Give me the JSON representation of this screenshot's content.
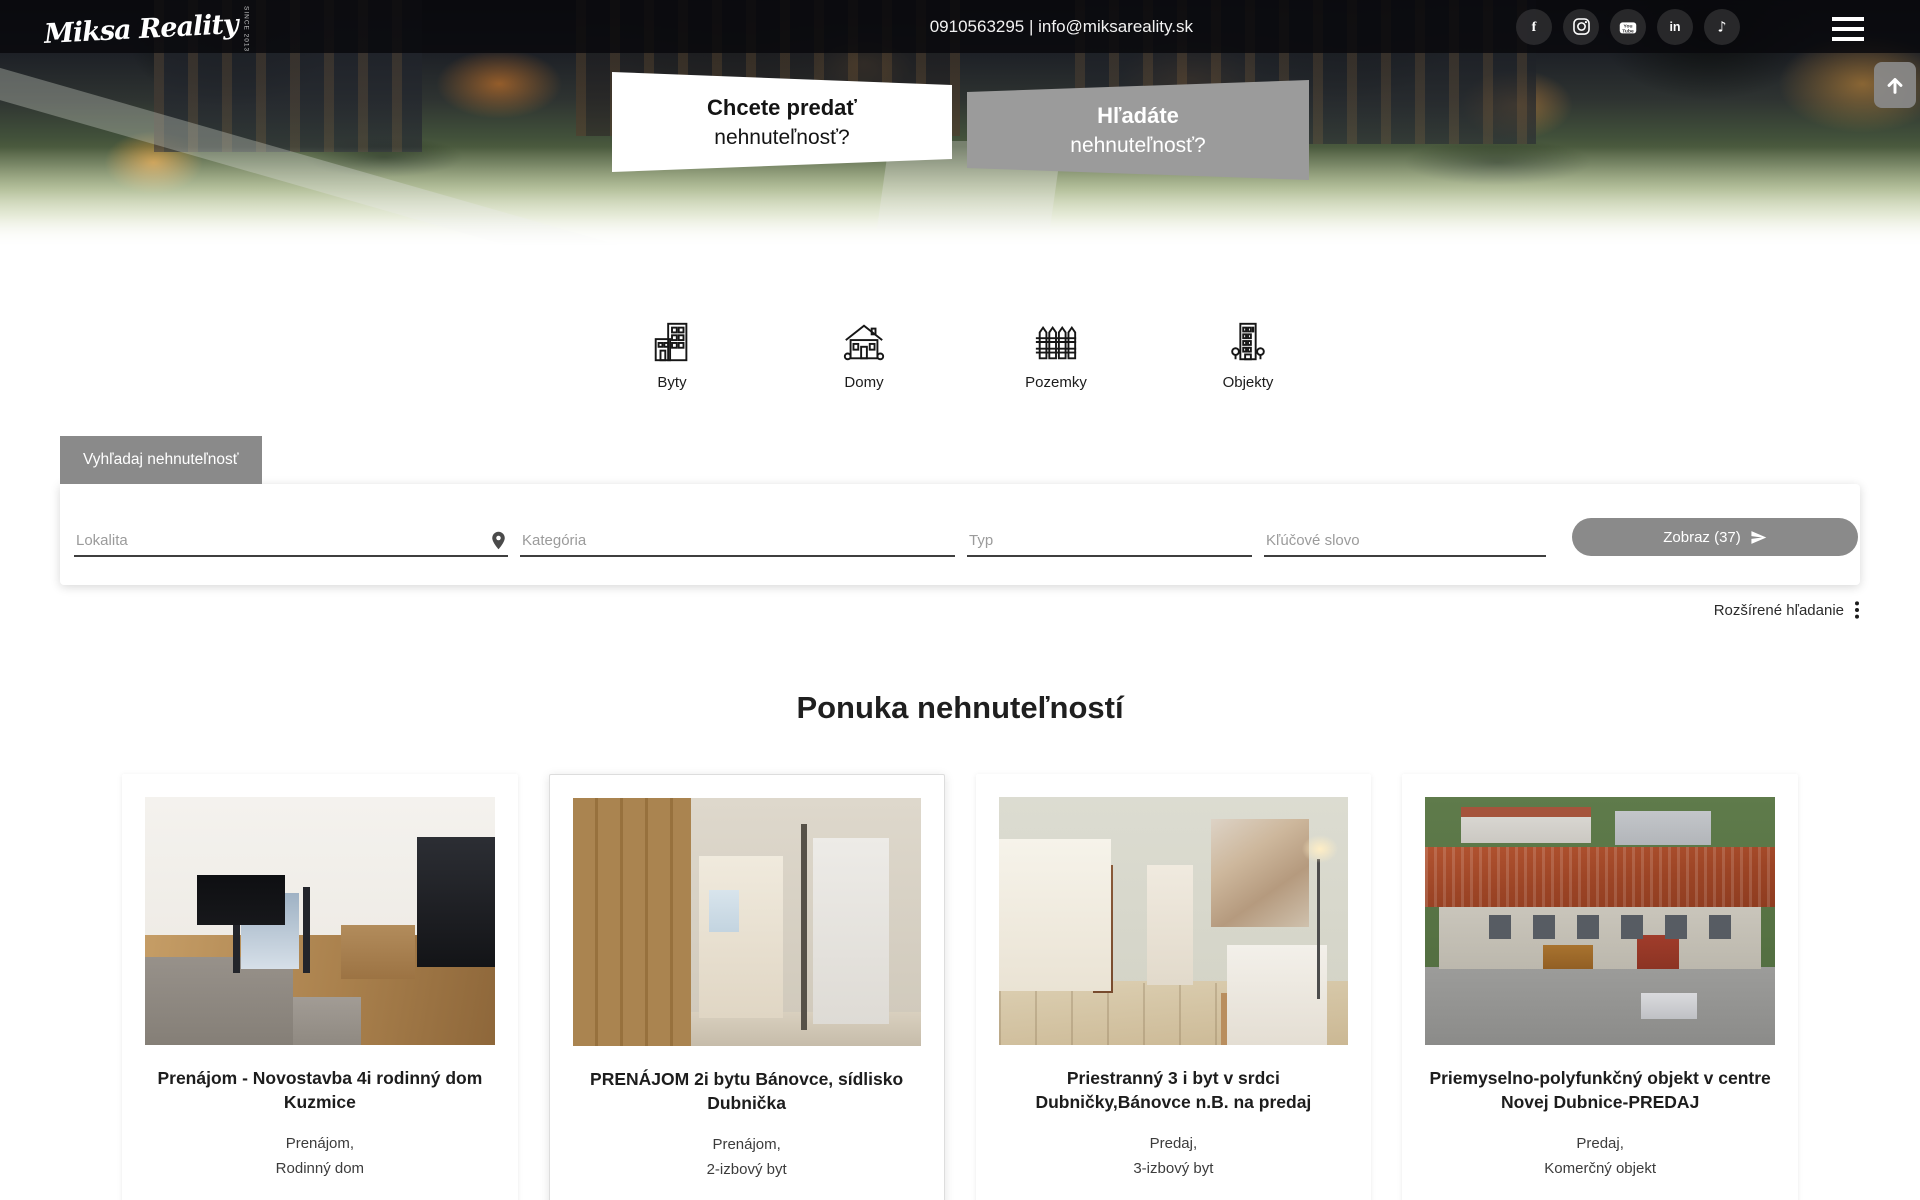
{
  "header": {
    "logo_text": "Miksa Reality",
    "logo_tagline": "since 2013",
    "contact": "0910563295 | info@miksareality.sk",
    "facebook_glyph": "f",
    "youtube_line1": "You",
    "youtube_line2": "Tube",
    "linkedin_glyph": "in",
    "tiktok_glyph": "♪",
    "banners": [
      {
        "line1": "Chcete predať",
        "line2": "nehnuteľnosť?"
      },
      {
        "line1": "Hľadáte",
        "line2": "nehnuteľnosť?"
      }
    ]
  },
  "categories": [
    {
      "label": "Byty"
    },
    {
      "label": "Domy"
    },
    {
      "label": "Pozemky"
    },
    {
      "label": "Objekty"
    }
  ],
  "search": {
    "tab_label": "Vyhľadaj nehnuteľnosť",
    "location_placeholder": "Lokalita",
    "category_placeholder": "Kategória",
    "type_placeholder": "Typ",
    "keyword_placeholder": "Kľúčové slovo",
    "submit_label": "Zobraz (37)",
    "advanced_label": "Rozšírené hľadanie"
  },
  "listings": {
    "title": "Ponuka nehnuteľností",
    "cards": [
      {
        "title": "Prenájom - Novostavba 4i rodinný dom Kuzmice",
        "type": "Prenájom,",
        "category": "Rodinný dom",
        "image": "living room with grey sofa, wooden floor and dark kitchen"
      },
      {
        "title": "PRENÁJOM 2i bytu Bánovce, sídlisko Dubnička",
        "type": "Prenájom,",
        "category": "2-izbový byt",
        "image": "hallway with wooden wardrobe and white door"
      },
      {
        "title": "Priestranný 3 i byt v srdci Dubničky,Bánovce n.B. na predaj",
        "type": "Predaj,",
        "category": "3-izbový byt",
        "image": "tiled room with angel painting and white armchair"
      },
      {
        "title": "Priemyselno-polyfunkčný objekt v centre Novej Dubnice-PREDAJ",
        "type": "Predaj,",
        "category": "Komerčný objekt",
        "image": "aerial view of building with red corrugated roof"
      }
    ]
  },
  "colors": {
    "accent_gray": "#8a8a8a",
    "banner_gray": "#9b9b9b",
    "topbar": "rgba(8,9,12,0.82)"
  }
}
